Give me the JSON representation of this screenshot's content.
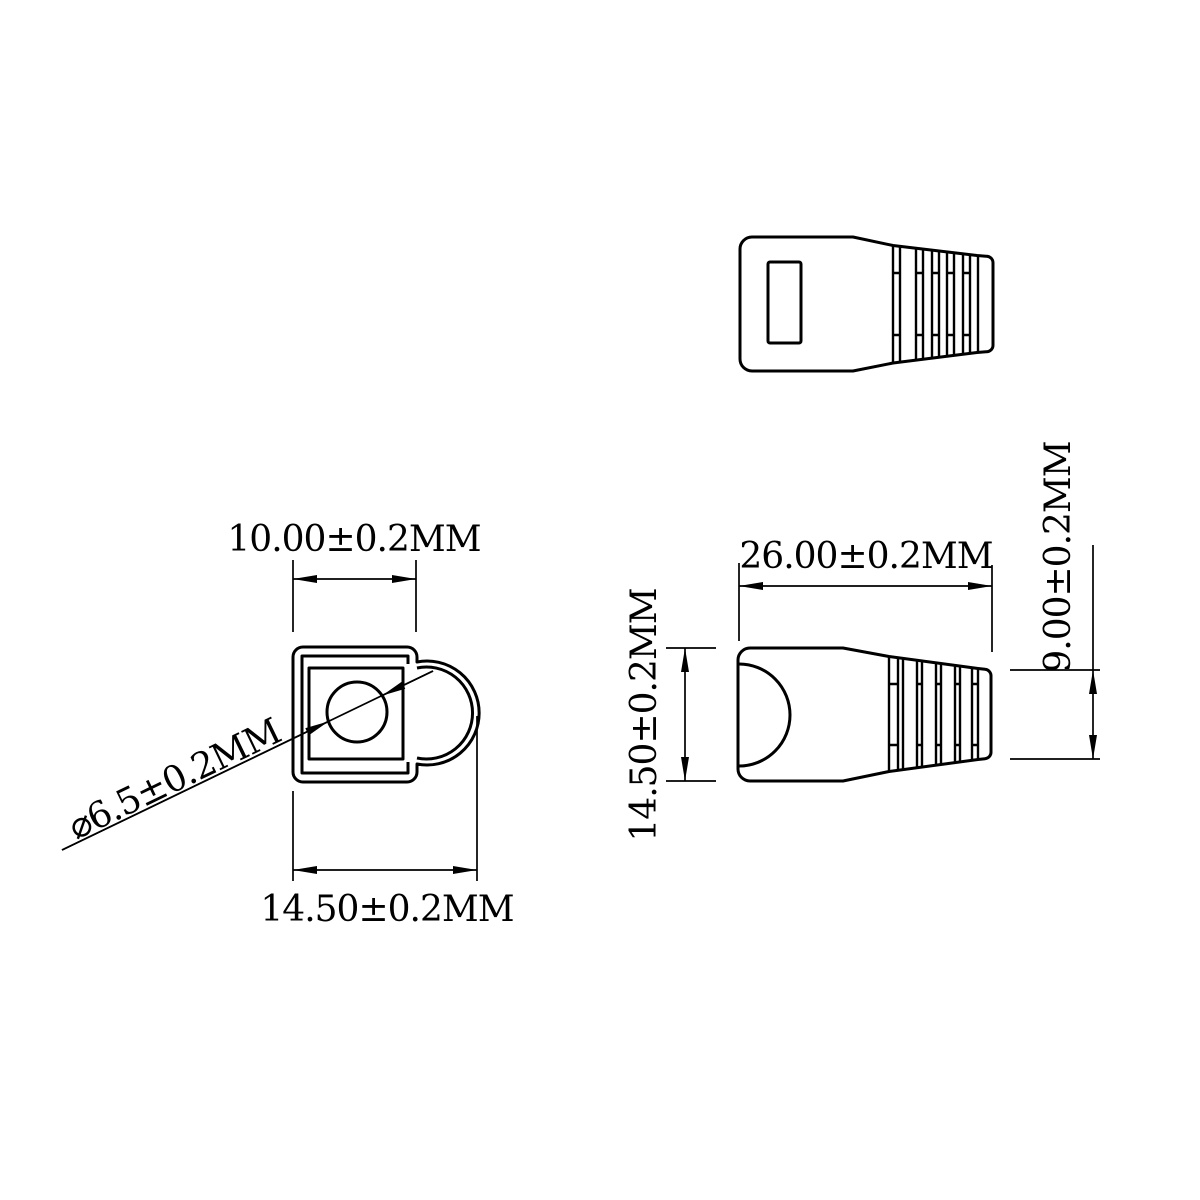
{
  "colors": {
    "line": "#000000",
    "background": "#ffffff"
  },
  "front_view": {
    "square_width_label": "10.00±0.2MM",
    "overall_width_label": "14.50±0.2MM",
    "hole_diameter_label": "⌀6.5±0.2MM"
  },
  "side_view": {
    "length_label": "26.00±0.2MM",
    "height_label": "14.50±0.2MM",
    "tail_height_label": "9.00±0.2MM"
  }
}
